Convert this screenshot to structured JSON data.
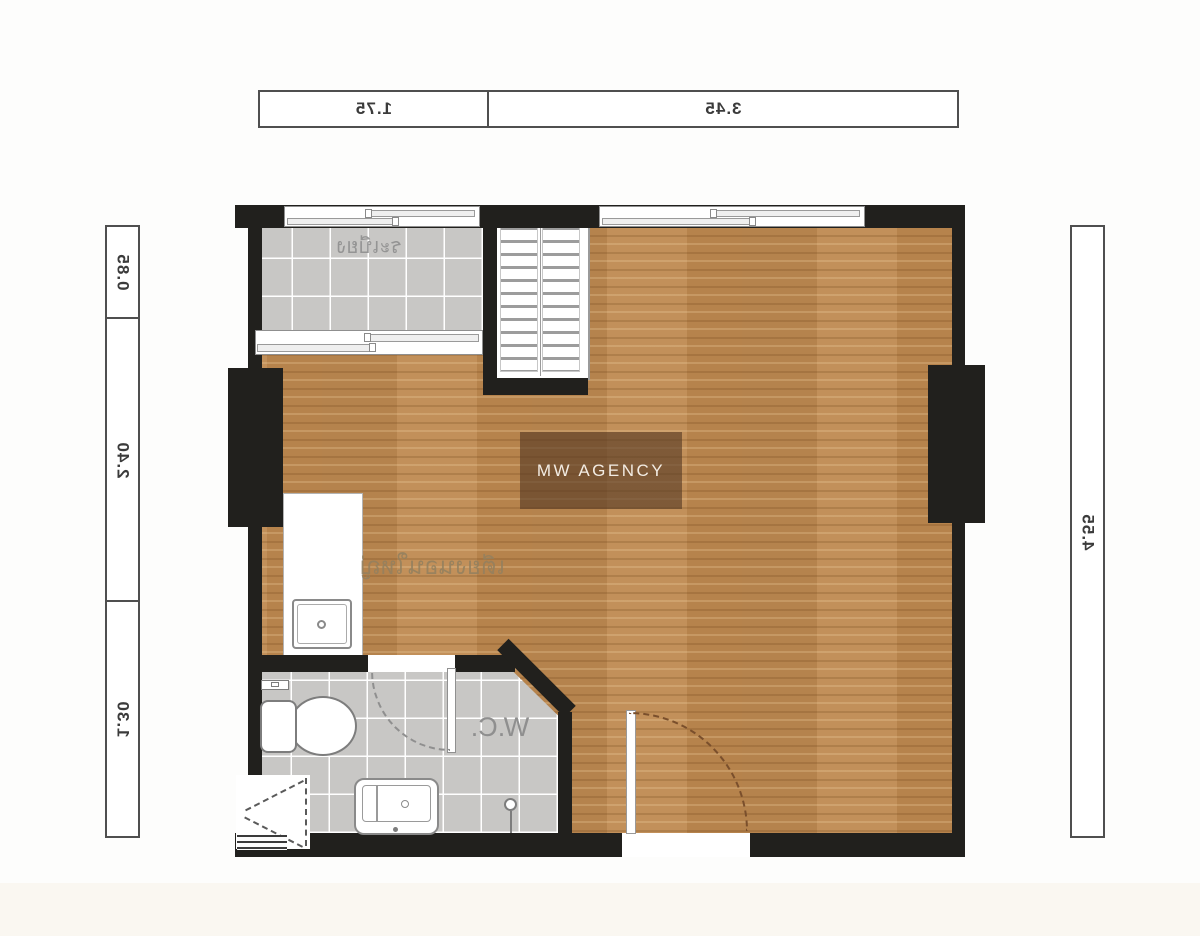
{
  "watermark": {
    "text": "MW AGENCY"
  },
  "dimension_bars": {
    "top": {
      "cells": [
        {
          "label": "1.75"
        },
        {
          "label": "3.45"
        }
      ]
    },
    "left": {
      "cells": [
        {
          "label": "0.85"
        },
        {
          "label": "2.40"
        },
        {
          "label": "1.30"
        }
      ]
    },
    "right": {
      "cells": [
        {
          "label": "4.55"
        }
      ]
    }
  },
  "rooms": {
    "balcony": {
      "label": "ระเบียง"
    },
    "main_area": {
      "label": "เตียงนอนใหญ่"
    },
    "bathroom": {
      "label": "W.C."
    }
  },
  "colors": {
    "wall": "#21201d",
    "wood_floor": "#bd8a52",
    "tile": "#c8c7c5",
    "watermark_bg": "#5c3e2a",
    "dimension_text": "#3b3b3b"
  }
}
